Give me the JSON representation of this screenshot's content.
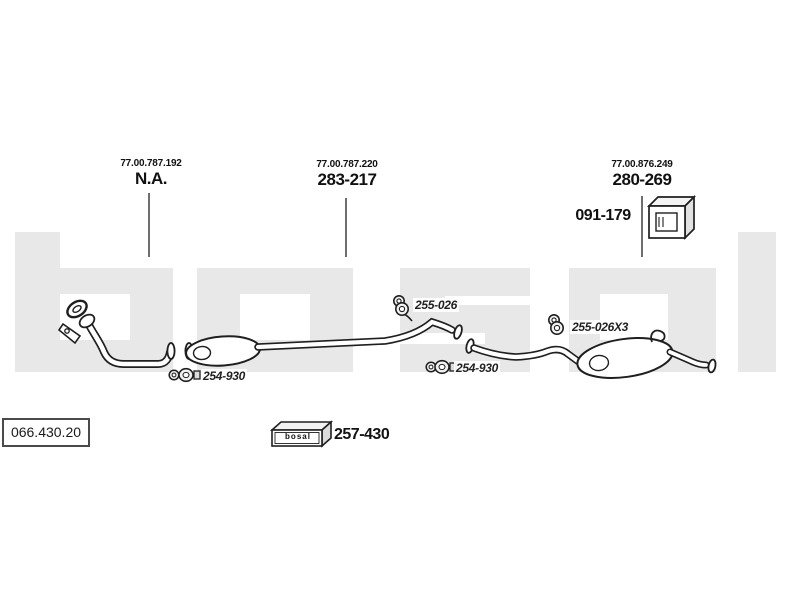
{
  "watermark": {
    "text": "bosal",
    "color": "#e8e8e8"
  },
  "callouts": [
    {
      "oem_ref": "77.00.787.192",
      "part": "N.A."
    },
    {
      "oem_ref": "77.00.787.220",
      "part": "283-217"
    },
    {
      "oem_ref": "77.00.876.249",
      "part": "280-269",
      "mount_part": "091-179"
    }
  ],
  "inline_parts": {
    "front_hanger": "255-026",
    "rear_hanger": "255-026X3",
    "front_clamp": "254-930",
    "rear_clamp": "254-930"
  },
  "footer": {
    "diagram_code": "066.430.20",
    "kit_brand": "bosal",
    "kit_part": "257-430"
  },
  "colors": {
    "line": "#1f1f1f",
    "leader": "#4a4a4a",
    "watermark": "#e8e8e8"
  }
}
